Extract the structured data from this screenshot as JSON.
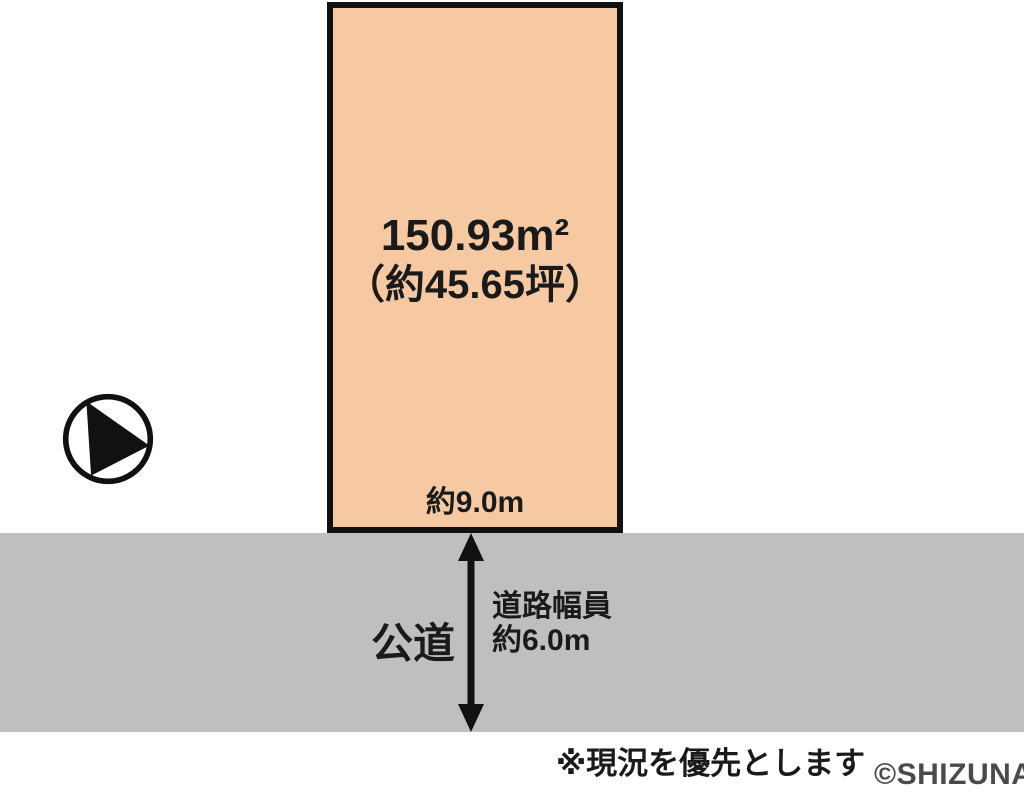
{
  "diagram": {
    "plot": {
      "area_label": "150.93m²",
      "tsubo_label": "（約45.65坪）",
      "frontage_label": "約9.0m",
      "fill_color": "#f6c9a2",
      "border_color": "#111111"
    },
    "road": {
      "name_label": "公道",
      "width_label_line1": "道路幅員",
      "width_label_line2": "約6.0m",
      "fill_color": "#bfbfbf",
      "arrow": {
        "direction": "vertical-double-headed",
        "color": "#111111"
      }
    },
    "compass": {
      "icon": "north-arrow-pointing-east",
      "circle_color": "#111111",
      "fill_color": "#ffffff"
    },
    "note": "※現況を優先とします",
    "watermark": "©SHIZUNAVI",
    "colors": {
      "background": "#ffffff",
      "text": "#1a1a1a",
      "watermark_text": "#4a4a4e"
    }
  }
}
